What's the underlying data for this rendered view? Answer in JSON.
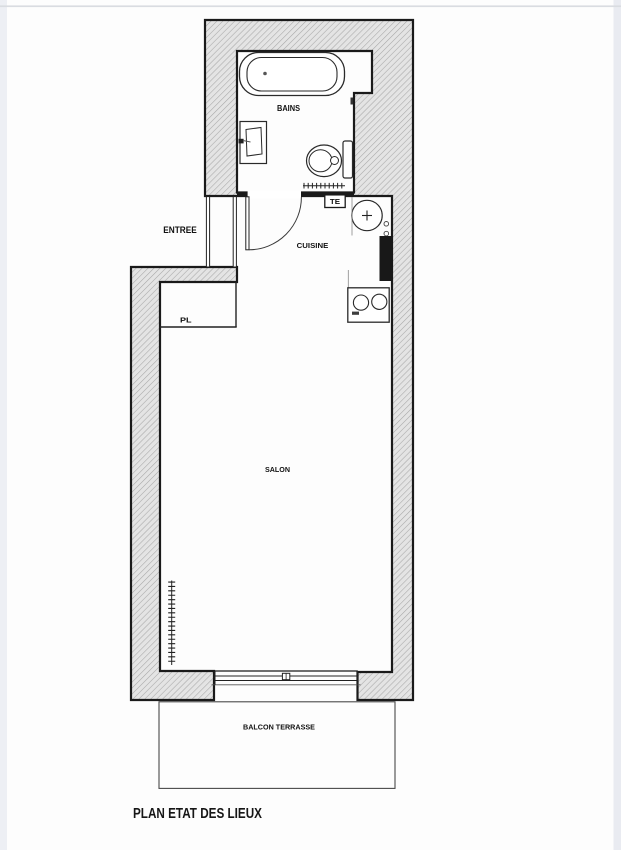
{
  "page": {
    "title": "PLAN ETAT DES LIEUX"
  },
  "rooms": {
    "bains": "BAINS",
    "entree": "ENTREE",
    "cuisine": "CUISINE",
    "pl": "PL",
    "salon": "SALON",
    "balcon": "BALCON TERRASSE"
  },
  "annotations": {
    "te": "TE"
  },
  "colors": {
    "wall_line": "#1a1a1a",
    "hatch_bg": "#e4e4e4",
    "hatch_line": "#a7a7a7",
    "fixture_line": "#2a2a2a",
    "duct_fill": "#181818",
    "text": "#111111",
    "photo_edge_left": "#edeff4",
    "photo_edge_right": "#e9ebf1",
    "photo_edge_top": "#d9dce1"
  }
}
